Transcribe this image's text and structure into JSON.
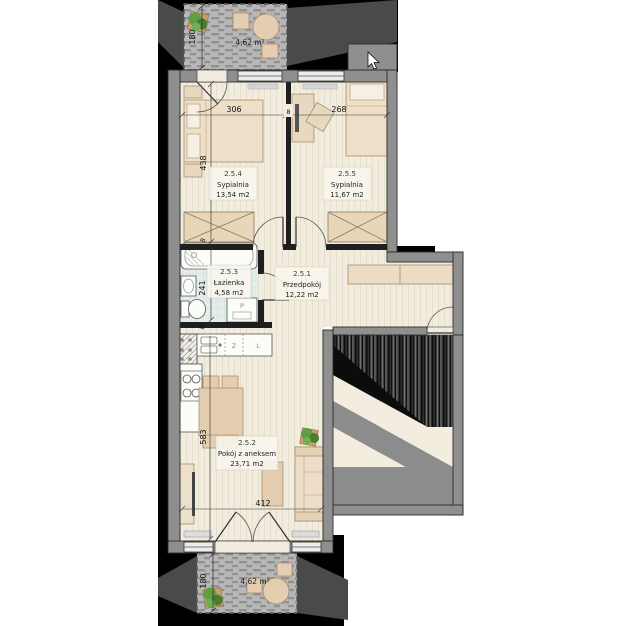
{
  "plan": {
    "rooms": [
      {
        "id": "2.5.4",
        "name": "Sypialnia",
        "area": "13,54 m2"
      },
      {
        "id": "2.5.5",
        "name": "Sypialnia",
        "area": "11,67 m2"
      },
      {
        "id": "2.5.3",
        "name": "Łazienka",
        "area": "4,58 m2"
      },
      {
        "id": "2.5.1",
        "name": "Przedpokój",
        "area": "12,22 m2"
      },
      {
        "id": "2.5.2",
        "name": "Pokój z aneksem",
        "area": "23,71 m2"
      }
    ],
    "balconies": [
      {
        "area": "4,62 m²",
        "depth": "180"
      },
      {
        "area": "4,62 m²",
        "depth": "180"
      }
    ],
    "dimensions": {
      "bedroom1_width": "306",
      "bedroom2_width": "268",
      "bedroom1_depth": "438",
      "bathroom_depth": "241",
      "living_depth": "583",
      "living_width": "412",
      "wall_thickness": "8"
    },
    "appliances": {
      "washing_machine": "P",
      "dishwasher": "Z",
      "fridge": "L"
    }
  },
  "colors": {
    "backdrop": "#000000",
    "shadow": "#4a4a4a",
    "wall_exterior": "#8f8f8f",
    "wall_interior": "#1f1f1f",
    "floor": "#f1ecdf",
    "bathroom_tile": "#e3edea",
    "balcony": "#b7b7b7",
    "furniture_beige": "#eedfc9",
    "plant_green": "#5f9e44"
  }
}
